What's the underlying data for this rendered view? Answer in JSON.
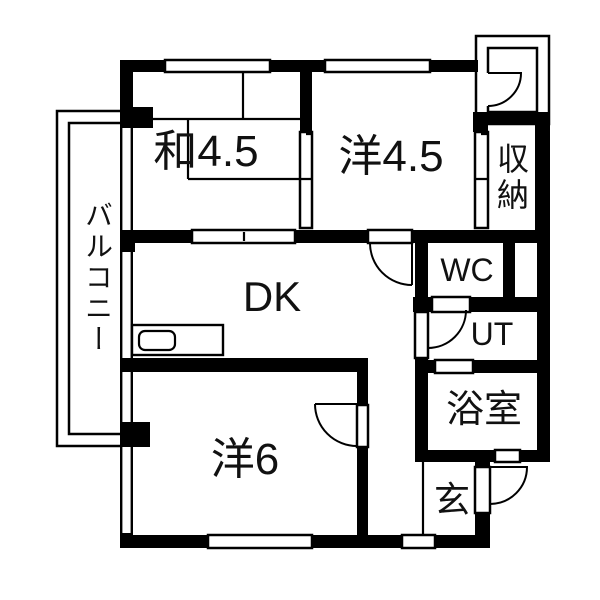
{
  "floorplan": {
    "kind": "apartment-floorplan",
    "colors": {
      "wall": "#000000",
      "floor": "#ffffff",
      "line": "#000000"
    },
    "rooms": {
      "washitsu": {
        "label": "和4.5"
      },
      "youshitsu45": {
        "label": "洋4.5"
      },
      "shuunou": {
        "label": "収納"
      },
      "dk": {
        "label": "DK"
      },
      "balcony": {
        "label": "バルコニー"
      },
      "wc": {
        "label": "WC"
      },
      "ut": {
        "label": "UT"
      },
      "bath": {
        "label": "浴室"
      },
      "youshitsu6": {
        "label": "洋6"
      },
      "genkan": {
        "label": "玄"
      }
    }
  }
}
